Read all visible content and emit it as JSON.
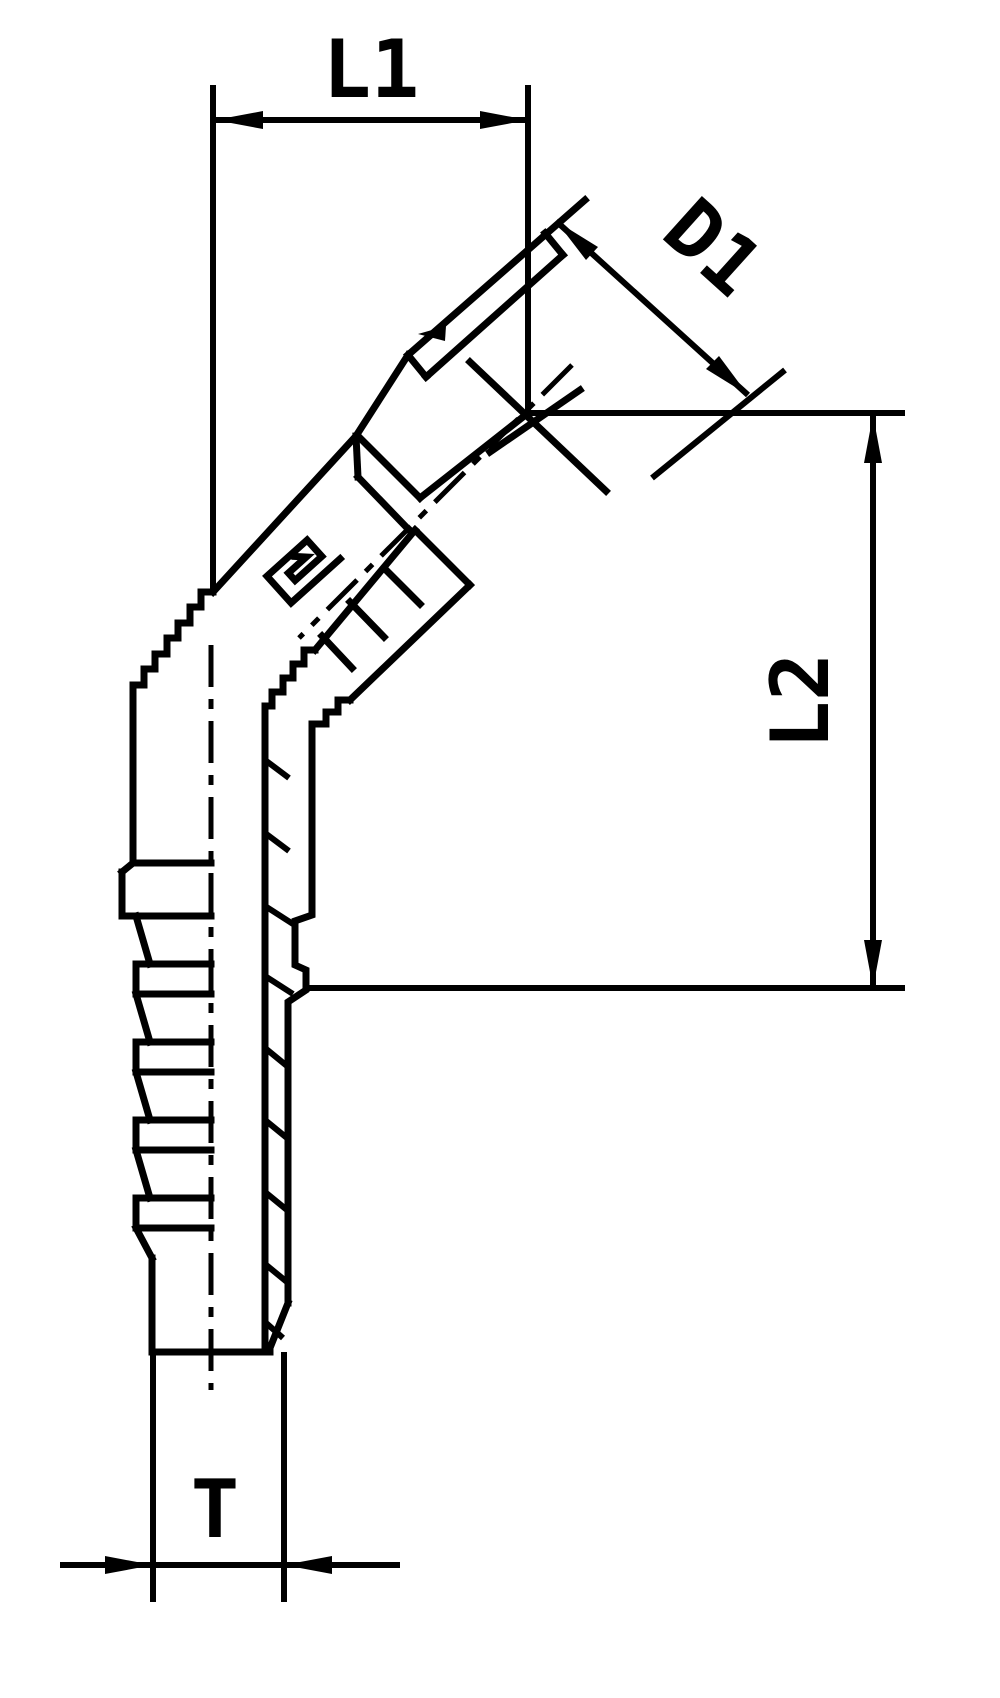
{
  "drawing": {
    "type": "technical-drawing",
    "subject": "45-degree flange hydraulic hose fitting - dimensional outline drawing",
    "background": "#ffffff",
    "line_color": "#000000",
    "labels": {
      "l1": "L1",
      "d1": "D1",
      "l2": "L2",
      "t": "T"
    }
  }
}
